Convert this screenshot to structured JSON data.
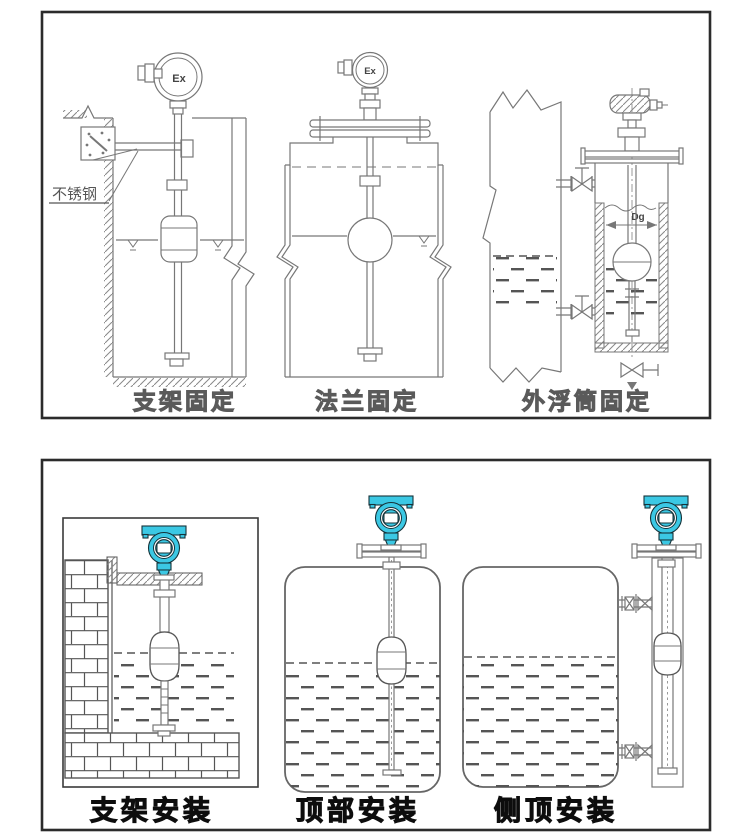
{
  "colors": {
    "accent": "#3BC8E4",
    "line": "#777777",
    "border": "#2B2B2B"
  },
  "top_panel": {
    "figures": [
      {
        "caption": "支架固定",
        "transmitter_label": "Ex",
        "material_label": "不锈钢"
      },
      {
        "caption": "法兰固定",
        "transmitter_label": "Ex"
      },
      {
        "caption": "外浮筒固定",
        "diameter_label": "Dg"
      }
    ]
  },
  "bottom_panel": {
    "figures": [
      {
        "caption": "支架安装"
      },
      {
        "caption": "顶部安装"
      },
      {
        "caption": "侧顶安装"
      }
    ]
  }
}
